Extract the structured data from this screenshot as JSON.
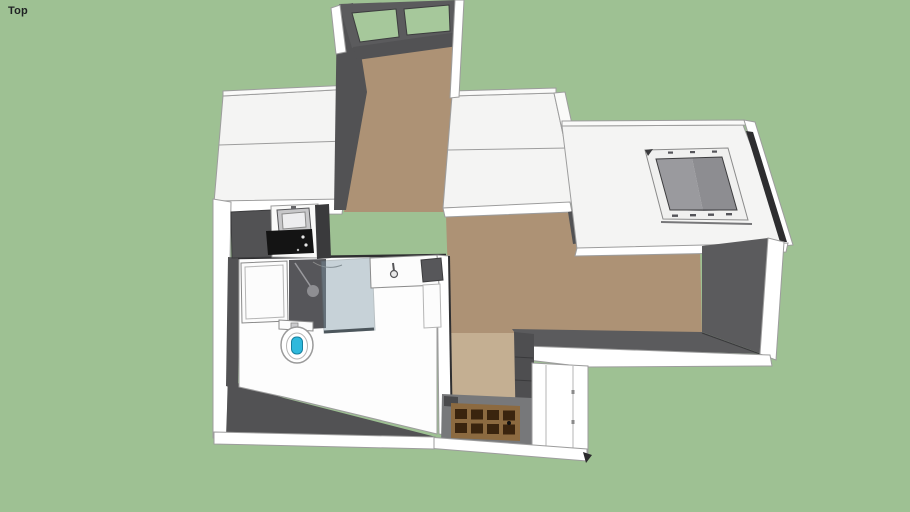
{
  "viewport": {
    "view_label": "Top"
  },
  "colors": {
    "background": "#9EC193",
    "roof_white": "#F4F4F3",
    "roof_parapet": "#FAFAF9",
    "wall_white": "#FFFFFF",
    "wall_gray_dark": "#525254",
    "wall_gray_mid": "#5B5B5D",
    "wall_gray_deep": "#3A3A3C",
    "shower_wall_gray": "#56565A",
    "cabinet_gray": "#4E4E50",
    "mirror_gray": "#57575A",
    "threshold_gray": "#77787A",
    "step_dark": "#4A4A4C",
    "notch_black": "#2A2A2C",
    "gutter_black": "#2E2E30",
    "floor_tan": "#AD9275",
    "floor_tan_light": "#C6B295",
    "bathroom_floor": "#FDFDFD",
    "fixture_white": "#FCFCFC",
    "steel_gray": "#C7C7C9",
    "basin_gray": "#EDEDEF",
    "wood_door_frame": "#8C6A40",
    "wood_door_panel": "#3A240E",
    "window_glass_green": "#A6C89B",
    "skylight_frame": "#F0F0EF",
    "skylight_glass_left": "#9A9A9E",
    "skylight_glass_right": "#8D8D91",
    "shower_glass": "#7E98A6",
    "toilet_seat_blue": "#2FB9DC",
    "cooktop_black": "#141414"
  }
}
